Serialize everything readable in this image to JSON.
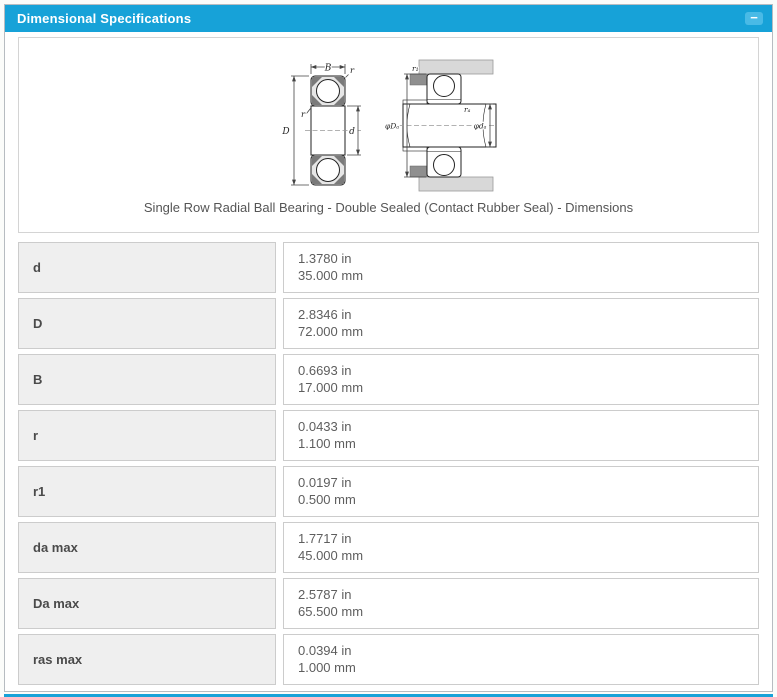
{
  "panel": {
    "title": "Dimensional Specifications",
    "collapse_glyph": "−"
  },
  "figure": {
    "caption": "Single Row Radial Ball Bearing - Double Sealed (Contact Rubber Seal) - Dimensions",
    "labels": {
      "B": "B",
      "r_outer": "r",
      "r_inner": "r",
      "D": "D",
      "d": "d",
      "r1": "r₁",
      "ra": "rₐ",
      "Da": "φDₐ",
      "da": "φdₐ"
    }
  },
  "table": {
    "rows": [
      {
        "label": "d",
        "inch": "1.3780 in",
        "mm": "35.000 mm"
      },
      {
        "label": "D",
        "inch": "2.8346 in",
        "mm": "72.000 mm"
      },
      {
        "label": "B",
        "inch": "0.6693 in",
        "mm": "17.000 mm"
      },
      {
        "label": "r",
        "inch": "0.0433 in",
        "mm": "1.100 mm"
      },
      {
        "label": "r1",
        "inch": "0.0197 in",
        "mm": "0.500 mm"
      },
      {
        "label": "da max",
        "inch": "1.7717 in",
        "mm": "45.000 mm"
      },
      {
        "label": "Da max",
        "inch": "2.5787 in",
        "mm": "65.500 mm"
      },
      {
        "label": "ras max",
        "inch": "0.0394 in",
        "mm": "1.000 mm"
      }
    ]
  },
  "colors": {
    "header": "#17a2d8",
    "label_cell_bg": "#efefef",
    "cell_border": "#cccccc"
  }
}
